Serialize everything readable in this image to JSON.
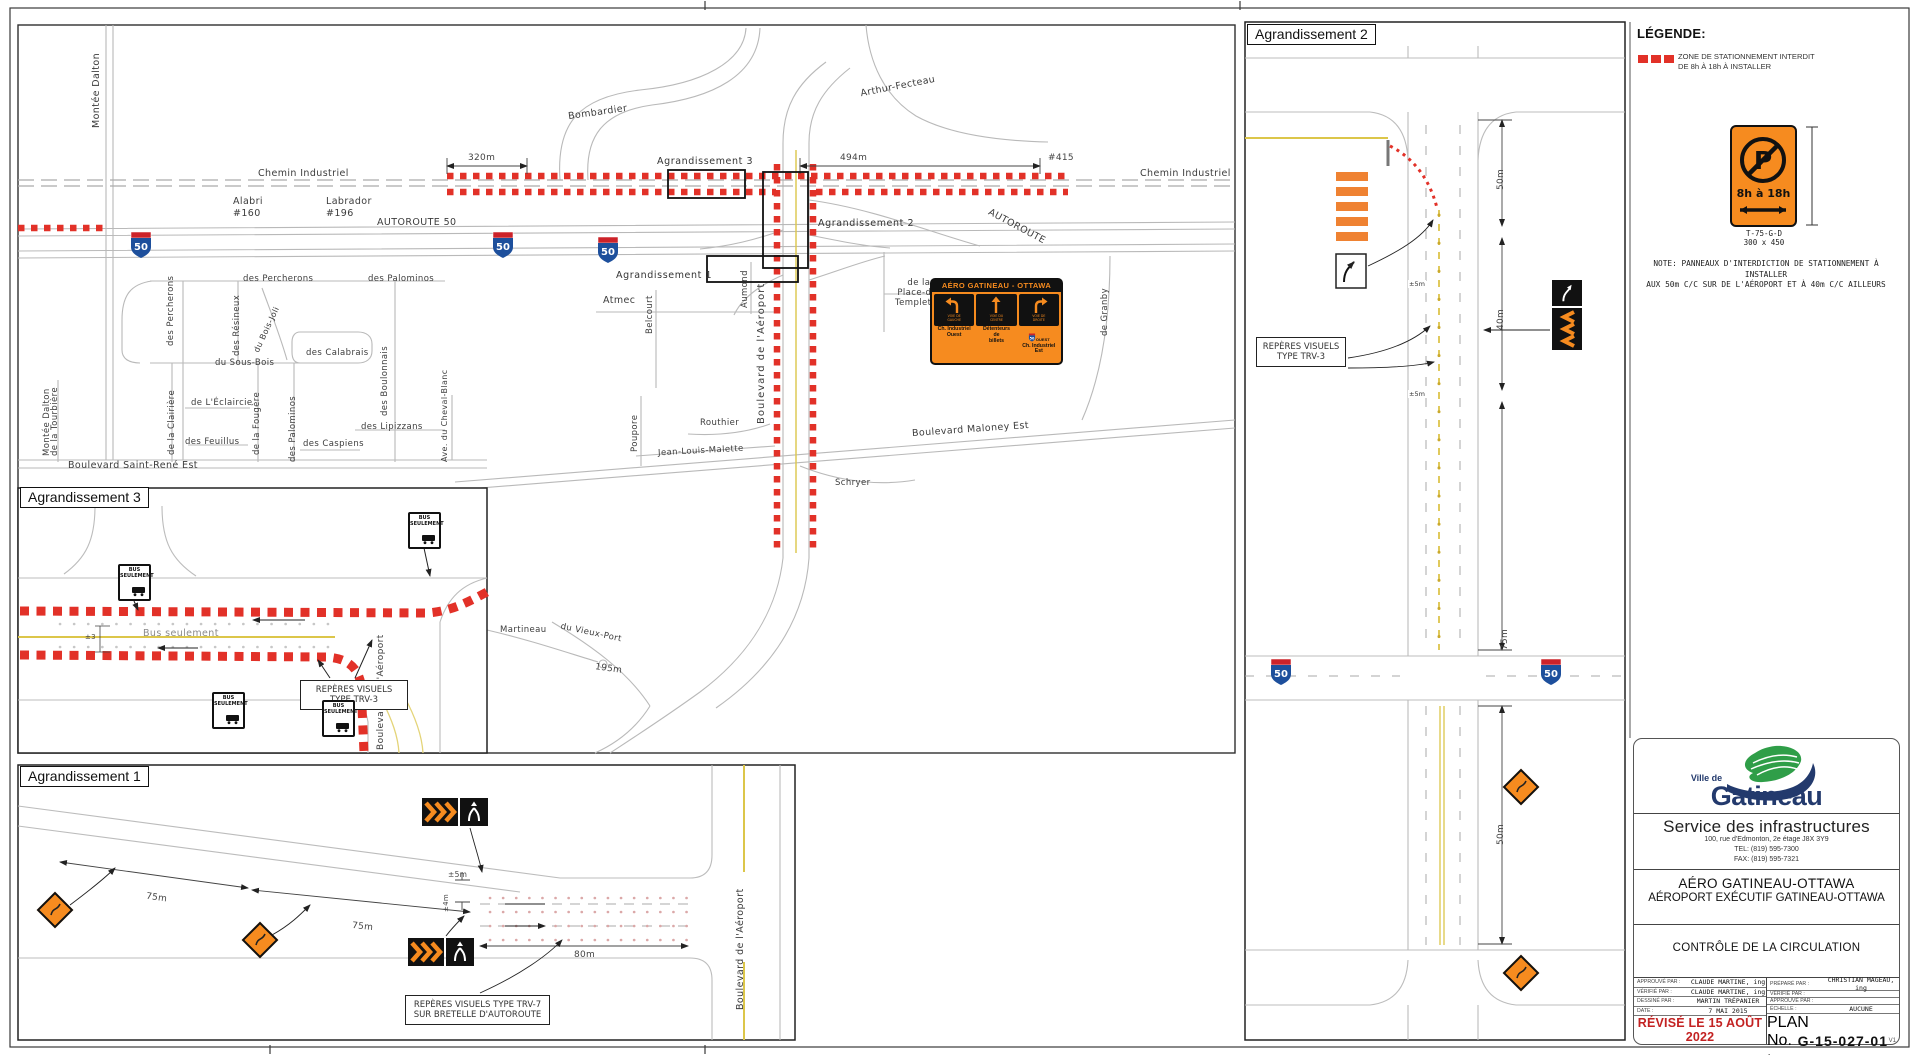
{
  "colors": {
    "red_zone": "#e23128",
    "orange_sign": "#f68b1f",
    "navy": "#233a6d",
    "green": "#2f9e48",
    "yellow_line": "#dcc64a",
    "shield_blue": "#1d4f9c",
    "shield_red": "#cc2229",
    "revised_red": "#c32222"
  },
  "legend": {
    "title": "LÉGENDE:",
    "zone_item": "ZONE DE STATIONNEMENT INTERDIT\nDE 8h À 18h À INSTALLER",
    "sign_letter": "P",
    "sign_hours": "8h à 18h",
    "sign_code": "T-75-G-D",
    "sign_size": "300 x 450",
    "note": "NOTE: PANNEAUX D'INTERDICTION DE STATIONNEMENT À INSTALLER\nAUX 50m C/C SUR DE L'AÉROPORT ET À 40m C/C AILLEURS"
  },
  "title_block": {
    "logo_top": "Ville de",
    "logo_name": "Gatineau",
    "dept": "Service des infrastructures",
    "address": "100, rue d'Edmonton, 2e étage J8X 3Y9",
    "tel": "TEL: (819) 595-7300",
    "fax": "FAX: (819) 595-7321",
    "project_line1": "AÉRO GATINEAU-OTTAWA",
    "project_line2": "AÉROPORT EXÉCUTIF GATINEAU-OTTAWA",
    "sheet_title": "CONTRÔLE DE LA CIRCULATION",
    "table": {
      "left": [
        {
          "label": "APPROUVÉ PAR :",
          "value": "CLAUDE MARTINE, ing"
        },
        {
          "label": "VÉRIFIÉ PAR :",
          "value": "CLAUDE MARTINE, ing"
        },
        {
          "label": "DESSINÉ PAR :",
          "value": "MARTIN TRÉPANIER"
        },
        {
          "label": "DATE :",
          "value": "7 MAI 2015"
        }
      ],
      "right": [
        {
          "label": "PRÉPARÉ PAR :",
          "value": "CHRISTIAN MAGEAU, ing"
        },
        {
          "label": "VÉRIFIÉ PAR :",
          "value": ""
        },
        {
          "label": "APPROUVÉ PAR :",
          "value": ""
        },
        {
          "label": "ÉCHELLE :",
          "value": "AUCUNE"
        }
      ],
      "revised": "RÉVISÉ LE 15 AOÛT 2022",
      "plan_label": "PLAN No. :",
      "plan_no": "G-15-027-01",
      "version": "V1"
    }
  },
  "shield": {
    "text": "50"
  },
  "bus_sign": {
    "line1": "BUS",
    "line2": "SEULEMENT"
  },
  "main_map": {
    "streets": [
      "Montée Dalton",
      "Chemin Industriel",
      "Chemin Industriel",
      "Bombardier",
      "Arthur-Fecteau",
      "Alabri",
      "#160",
      "Labrador",
      "#196",
      "AUTOROUTE 50",
      "AUTOROUTE",
      "des Percherons",
      "des Percherons",
      "des Palominos",
      "des Résineux",
      "du Bois-Joli",
      "du Sous-Bois",
      "des Calabrais",
      "des Boulonnais",
      "de la Tourbière",
      "de la Clairière",
      "de L'Éclaircie",
      "de la Fougère",
      "des Palominos",
      "des Feuillus",
      "des Lipizzans",
      "des Caspiens",
      "Ave. du Cheval-Blanc",
      "Montée Dalton",
      "Boulevard Saint-René Est",
      "Atmec",
      "Belcourt",
      "Aumond",
      "de la\nPlace-de-\nTempleton",
      "Boulevard de l'Aéroport",
      "Poupore",
      "Routhier",
      "Jean-Louis-Malette",
      "Boulevard Maloney Est",
      "Schryer",
      "Martineau",
      "du Vieux-Port",
      "de Granby"
    ],
    "dims": {
      "d320": "320m",
      "d494": "494m",
      "n415": "#415",
      "d195": "195m"
    },
    "callouts": [
      "Agrandissement 1",
      "Agrandissement 2",
      "Agrandissement 3"
    ],
    "guide_sign": {
      "header": "AÉRO GATINEAU - OTTAWA",
      "lane1_caption": "VOIE DE\nGAUCHE",
      "lane2_caption": "VOIE DU\nCENTRE",
      "lane3_caption": "VOIE DE\nDROITE",
      "lane1_dest": "Ch. Industriel\nOuest",
      "lane2_dest": "Détenteurs\nde\nbillets",
      "lane3_dest": "Ch. Industriel\nEst",
      "lane3_shield_label": "OUEST"
    }
  },
  "inset1": {
    "title": "Agrandissement 1",
    "d75a": "75m",
    "d75b": "75m",
    "d80": "80m",
    "d5": "±5m",
    "d4": "±4m",
    "note": "REPÈRES VISUELS TYPE TRV-7\nSUR BRETELLE D'AUTOROUTE",
    "street": "Boulevard de l'Aéroport"
  },
  "inset2": {
    "title": "Agrandissement 2",
    "d50a": "50m",
    "d40": "40m",
    "d75": "75m",
    "d50b": "50m",
    "pm5a": "±5m",
    "pm5b": "±5m",
    "note": "REPÈRES VISUELS\nTYPE TRV-3"
  },
  "inset3": {
    "title": "Agrandissement 3",
    "bus_only": "Bus seulement",
    "note": "REPÈRES VISUELS\nTYPE TRV-3",
    "street": "Boulevard de l'Aéroport",
    "pm3": "±3"
  }
}
